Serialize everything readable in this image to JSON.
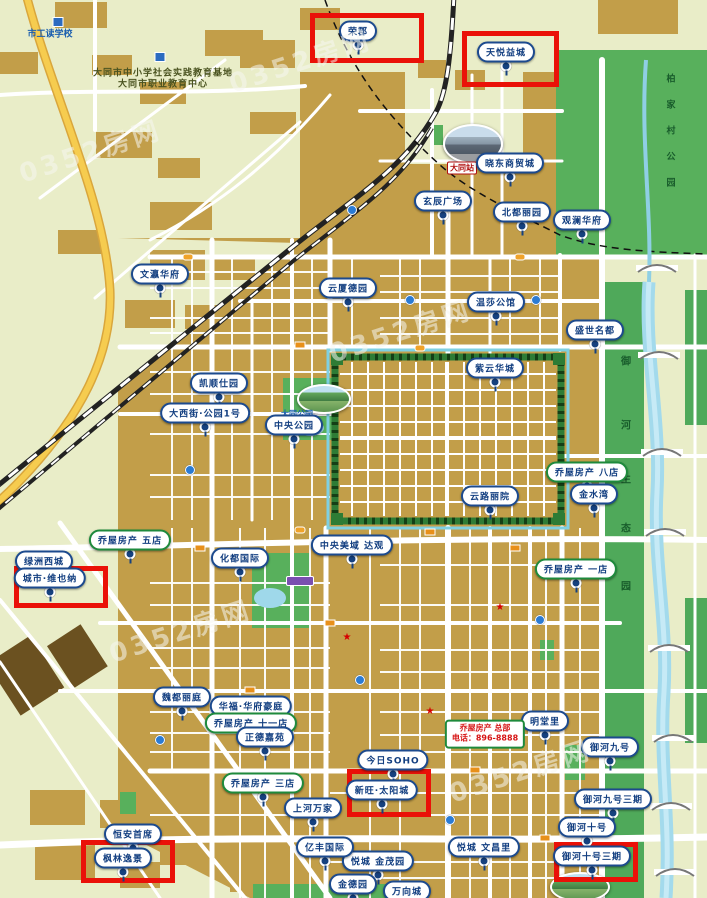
{
  "map": {
    "colors": {
      "label_border": "#1C4A8E",
      "label_text": "#123E80",
      "store_label_border": "#1E8A3C",
      "highlight_box": "#EA1108",
      "urban_block": "#C29E49",
      "park_green": "#58B05C",
      "eco_strip_green": "#4FA95A",
      "water": "#A3DAEC",
      "road": "#FFFFFF",
      "highway": "#F6CC4F"
    },
    "watermark_text": "0352房网",
    "labels": [
      {
        "name": "rongjun",
        "text": "荣郡",
        "x": 358,
        "y": 31
      },
      {
        "name": "tianyue-yicheng",
        "text": "天悦益城",
        "x": 506,
        "y": 52
      },
      {
        "name": "xiaodong-shangmaocheng",
        "text": "晓东商贸城",
        "x": 510,
        "y": 163
      },
      {
        "name": "xuanchen-guangchang",
        "text": "玄辰广场",
        "x": 443,
        "y": 201
      },
      {
        "name": "beidu-liyuan",
        "text": "北都丽园",
        "x": 522,
        "y": 212
      },
      {
        "name": "guanlan-huafu",
        "text": "观澜华府",
        "x": 582,
        "y": 220
      },
      {
        "name": "wenying-huafu",
        "text": "文瀛华府",
        "x": 160,
        "y": 274
      },
      {
        "name": "yunsha-deyuan",
        "text": "云厦德园",
        "x": 348,
        "y": 288
      },
      {
        "name": "wensha-gongguan",
        "text": "温莎公馆",
        "x": 496,
        "y": 302
      },
      {
        "name": "shengshi-mingdu",
        "text": "盛世名都",
        "x": 595,
        "y": 330
      },
      {
        "name": "ziyun-huacheng",
        "text": "紫云华城",
        "x": 495,
        "y": 368
      },
      {
        "name": "kaishun-shiyuan",
        "text": "凯顺仕园",
        "x": 219,
        "y": 383
      },
      {
        "name": "daxijie-gongyuan-1hao",
        "text": "大西街·公园1号",
        "x": 205,
        "y": 413
      },
      {
        "name": "zhongyang-gongyuan",
        "text": "中央公园",
        "x": 294,
        "y": 425
      },
      {
        "name": "qiaowu-fangchan-badian",
        "text": "乔屋房产 八店",
        "x": 587,
        "y": 472,
        "style": "pill-green"
      },
      {
        "name": "yunlu-liyuan",
        "text": "云路丽院",
        "x": 490,
        "y": 496
      },
      {
        "name": "jinshuiwan",
        "text": "金水湾",
        "x": 594,
        "y": 494
      },
      {
        "name": "zhongyang-meiyu-daguan",
        "text": "中央美域 达观",
        "x": 352,
        "y": 545
      },
      {
        "name": "huadu-guoji",
        "text": "化都国际",
        "x": 240,
        "y": 558
      },
      {
        "name": "qiaowu-fangchan-wudian",
        "text": "乔屋房产 五店",
        "x": 130,
        "y": 540,
        "style": "pill-green"
      },
      {
        "name": "lvzhou-xicheng",
        "text": "绿洲西城",
        "x": 44,
        "y": 561
      },
      {
        "name": "chengshi-weiyena",
        "text": "城市·维也纳",
        "x": 50,
        "y": 578
      },
      {
        "name": "qiaowu-fangchan-yidian",
        "text": "乔屋房产 一店",
        "x": 576,
        "y": 569,
        "style": "pill-green"
      },
      {
        "name": "weidu-liting",
        "text": "魏都丽庭",
        "x": 182,
        "y": 697
      },
      {
        "name": "huafu-huafu-haoting",
        "text": "华福·华府豪庭",
        "x": 251,
        "y": 706
      },
      {
        "name": "qiaowu-fangchan-shiyidian",
        "text": "乔屋房产 十一店",
        "x": 251,
        "y": 723,
        "style": "pill-green"
      },
      {
        "name": "zhengde-jiayuan",
        "text": "正德嘉苑",
        "x": 265,
        "y": 737
      },
      {
        "name": "jinri-soho",
        "text": "今日SOHO",
        "x": 393,
        "y": 760
      },
      {
        "name": "xinwang-taiyangcheng",
        "text": "新旺·太阳城",
        "x": 382,
        "y": 790
      },
      {
        "name": "qiaowu-fangchan-sandian",
        "text": "乔屋房产 三店",
        "x": 263,
        "y": 783,
        "style": "pill-green"
      },
      {
        "name": "shanghe-wanjia",
        "text": "上河万家",
        "x": 313,
        "y": 808
      },
      {
        "name": "mingtangli",
        "text": "明堂里",
        "x": 545,
        "y": 721
      },
      {
        "name": "yuhe-jiuhao",
        "text": "御河九号",
        "x": 610,
        "y": 747
      },
      {
        "name": "yuhe-jiuhao-sanqi",
        "text": "御河九号三期",
        "x": 613,
        "y": 799
      },
      {
        "name": "yuhe-shihao",
        "text": "御河十号",
        "x": 587,
        "y": 827
      },
      {
        "name": "yuhe-shihao-sanqi",
        "text": "御河十号三期",
        "x": 592,
        "y": 856
      },
      {
        "name": "yuecheng-wenchangli",
        "text": "悦城 文昌里",
        "x": 484,
        "y": 847
      },
      {
        "name": "yuecheng-jinmaoyuan",
        "text": "悦城 金茂园",
        "x": 378,
        "y": 861
      },
      {
        "name": "yifeng-guoji",
        "text": "亿丰国际",
        "x": 325,
        "y": 847
      },
      {
        "name": "jindeyuan",
        "text": "金德园",
        "x": 353,
        "y": 884
      },
      {
        "name": "wanxiangcheng",
        "text": "万向城",
        "x": 407,
        "y": 891
      },
      {
        "name": "hengan-shouxi",
        "text": "恒安首席",
        "x": 133,
        "y": 834
      },
      {
        "name": "fenglin-yijing",
        "text": "枫林逸景",
        "x": 123,
        "y": 858
      }
    ],
    "highlight_boxes": [
      {
        "of": "rongjun",
        "x": 310,
        "y": 13,
        "w": 104,
        "h": 40
      },
      {
        "of": "tianyue-yicheng",
        "x": 462,
        "y": 31,
        "w": 87,
        "h": 46
      },
      {
        "of": "chengshi-weiyena",
        "x": 14,
        "y": 566,
        "w": 84,
        "h": 32
      },
      {
        "of": "xinwang-taiyangcheng",
        "x": 347,
        "y": 769,
        "w": 74,
        "h": 38
      },
      {
        "of": "fenglin-yijing",
        "x": 81,
        "y": 840,
        "w": 84,
        "h": 33
      },
      {
        "of": "yuhe-shihao-sanqi",
        "x": 554,
        "y": 842,
        "w": 74,
        "h": 30
      }
    ],
    "info_box": {
      "name": "qiaowu-fangchan-zongbu",
      "lines": [
        "乔屋房产 总部",
        "电话：896-8888"
      ],
      "x": 485,
      "y": 734
    },
    "vertical_texts": [
      {
        "name": "baijiacun-park-name",
        "text": "柏家村公园",
        "x": 671,
        "ys": [
          78,
          104,
          130,
          156,
          182
        ],
        "size": 9
      },
      {
        "name": "yuhe-eco-park-name",
        "text": "御河生态园",
        "x": 626,
        "ys": [
          360,
          424,
          478,
          527,
          585
        ],
        "size": 10
      }
    ],
    "small_texts": [
      {
        "name": "shigongdu-school",
        "text": "市工读学校",
        "x": 50,
        "y": 33,
        "cls": "txt-blue"
      },
      {
        "name": "education-base-line1",
        "text": "大同市中小学社会实践教育基地",
        "x": 163,
        "y": 72,
        "cls": "txt-olive"
      },
      {
        "name": "education-base-line2",
        "text": "大同市职业教育中心",
        "x": 163,
        "y": 83,
        "cls": "txt-olive"
      },
      {
        "name": "datong-station-name",
        "text": "大同站",
        "x": 462,
        "y": 168,
        "cls": "txt-station"
      },
      {
        "name": "datong-park-name",
        "text": "大同公园",
        "x": 297,
        "y": 414,
        "cls": "txt-parkname"
      }
    ],
    "photos": [
      {
        "name": "datong-station-photo",
        "kind": "station",
        "x": 443,
        "y": 124,
        "w": 56,
        "h": 36
      },
      {
        "name": "datong-park-photo",
        "kind": "park",
        "x": 297,
        "y": 384,
        "w": 50,
        "h": 26
      },
      {
        "name": "riverside-park-photo",
        "kind": "park",
        "x": 550,
        "y": 872,
        "w": 56,
        "h": 26
      }
    ],
    "watermarks": [
      {
        "x": 90,
        "y": 150
      },
      {
        "x": 400,
        "y": 330
      },
      {
        "x": 180,
        "y": 630
      },
      {
        "x": 520,
        "y": 770
      },
      {
        "x": 300,
        "y": 60
      }
    ],
    "poi_icons": [
      {
        "type": "school-icon",
        "x": 58,
        "y": 22
      },
      {
        "type": "school-icon",
        "x": 160,
        "y": 57
      },
      {
        "type": "info-icon",
        "x": 352,
        "y": 210
      },
      {
        "type": "info-icon",
        "x": 410,
        "y": 300
      },
      {
        "type": "info-icon",
        "x": 536,
        "y": 300
      },
      {
        "type": "info-icon",
        "x": 190,
        "y": 470
      },
      {
        "type": "info-icon",
        "x": 540,
        "y": 620
      },
      {
        "type": "info-icon",
        "x": 360,
        "y": 680
      },
      {
        "type": "info-icon",
        "x": 160,
        "y": 740
      },
      {
        "type": "info-icon",
        "x": 450,
        "y": 820
      },
      {
        "type": "bus-stop-icon",
        "x": 300,
        "y": 345
      },
      {
        "type": "bus-stop-icon",
        "x": 430,
        "y": 532
      },
      {
        "type": "bus-stop-icon",
        "x": 515,
        "y": 548
      },
      {
        "type": "bus-stop-icon",
        "x": 200,
        "y": 548
      },
      {
        "type": "bus-stop-icon",
        "x": 330,
        "y": 623
      },
      {
        "type": "bus-stop-icon",
        "x": 475,
        "y": 770
      },
      {
        "type": "bus-stop-icon",
        "x": 545,
        "y": 838
      },
      {
        "type": "bus-stop-icon",
        "x": 250,
        "y": 690
      },
      {
        "type": "star-icon",
        "x": 500,
        "y": 608
      },
      {
        "type": "star-icon",
        "x": 347,
        "y": 638
      },
      {
        "type": "star-icon",
        "x": 430,
        "y": 712
      },
      {
        "type": "road-badge",
        "x": 188,
        "y": 257
      },
      {
        "type": "road-badge",
        "x": 420,
        "y": 348
      },
      {
        "type": "road-badge",
        "x": 300,
        "y": 530
      },
      {
        "type": "road-badge",
        "x": 520,
        "y": 257
      },
      {
        "type": "park-badge",
        "x": 300,
        "y": 581
      }
    ]
  }
}
